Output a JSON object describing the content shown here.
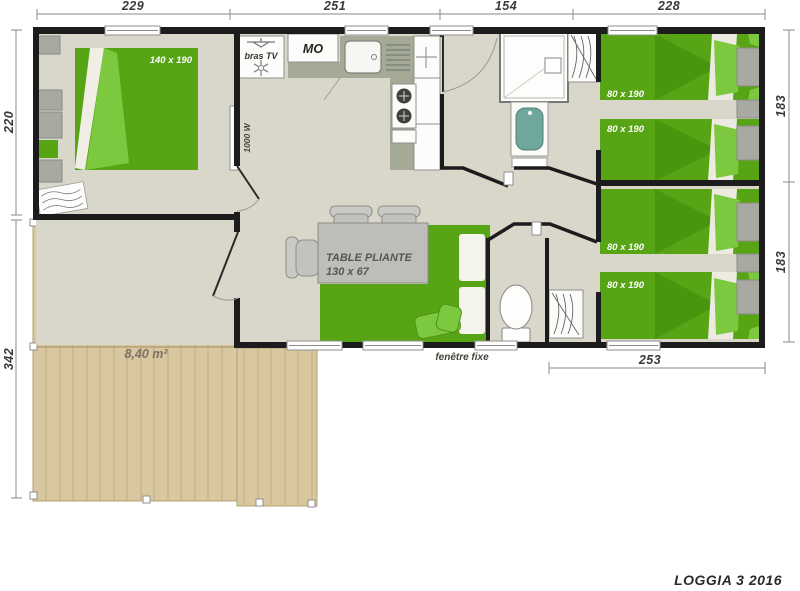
{
  "title": "LOGGIA 3 2016",
  "dims": {
    "top": [
      "229",
      "251",
      "154",
      "228"
    ],
    "left_top": "220",
    "left_bottom": "342",
    "right_top": "183",
    "right_bottom": "183",
    "bottom_right": "253"
  },
  "labels": {
    "master_bed": "140 x 190",
    "bed_tr_1": "80 x 190",
    "bed_tr_2": "80 x 190",
    "bed_br_1": "80 x 190",
    "bed_br_2": "80 x 190",
    "bras_tv": "bras TV",
    "microwave": "MO",
    "heater": "1000 W",
    "table_line1": "TABLE PLIANTE",
    "table_line2": "130 x 67",
    "window_fixed": "fenêtre fixe",
    "terrace_name": "TERRASSE",
    "terrace_area": "8,40 m²"
  },
  "colors": {
    "bed_green": "#57a515",
    "bed_green_dark": "#4a950e",
    "bed_green_light": "#7cc83e",
    "wood": "#d9c7a0",
    "floor": "#d9d7ca",
    "wall": "#1c1c1c",
    "counter_sage": "#a4aa96",
    "table_gray": "#bdbdb9",
    "basin_teal": "#6fa79d"
  }
}
